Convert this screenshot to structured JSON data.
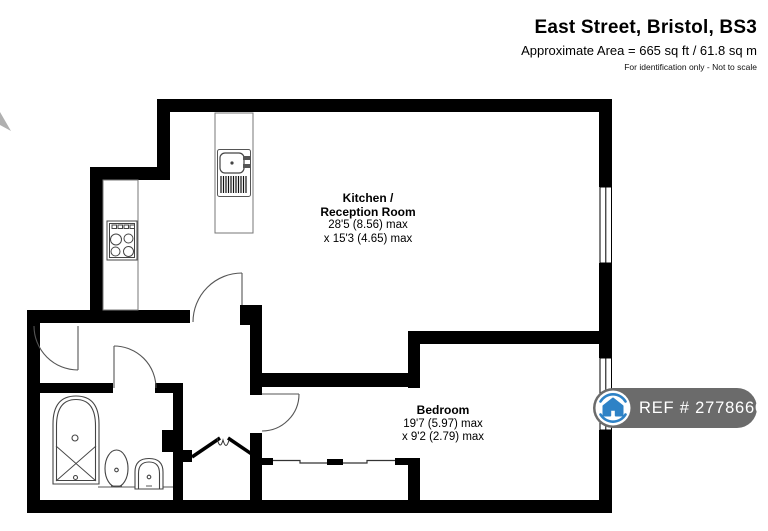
{
  "header": {
    "title": "East Street, Bristol, BS3",
    "area_line": "Approximate Area = 665 sq ft / 61.8 sq m",
    "disclaimer": "For identification only - Not to scale"
  },
  "rooms": {
    "kitchen": {
      "name_line1": "Kitchen /",
      "name_line2": "Reception Room",
      "dimensions_line1": "28'5 (8.56) max",
      "dimensions_line2": "x 15'3 (4.65) max"
    },
    "bedroom": {
      "name": "Bedroom",
      "dimensions_line1": "19'7 (5.97) max",
      "dimensions_line2": "x 9'2 (2.79) max"
    }
  },
  "badge": {
    "label": "REF # 2778660",
    "icon": "house-icon"
  },
  "colors": {
    "wall": "#000000",
    "badge_background": "#6b6b6b",
    "badge_text": "#ffffff",
    "brand_blue": "#2e82c6",
    "fixture_line": "#444444"
  }
}
